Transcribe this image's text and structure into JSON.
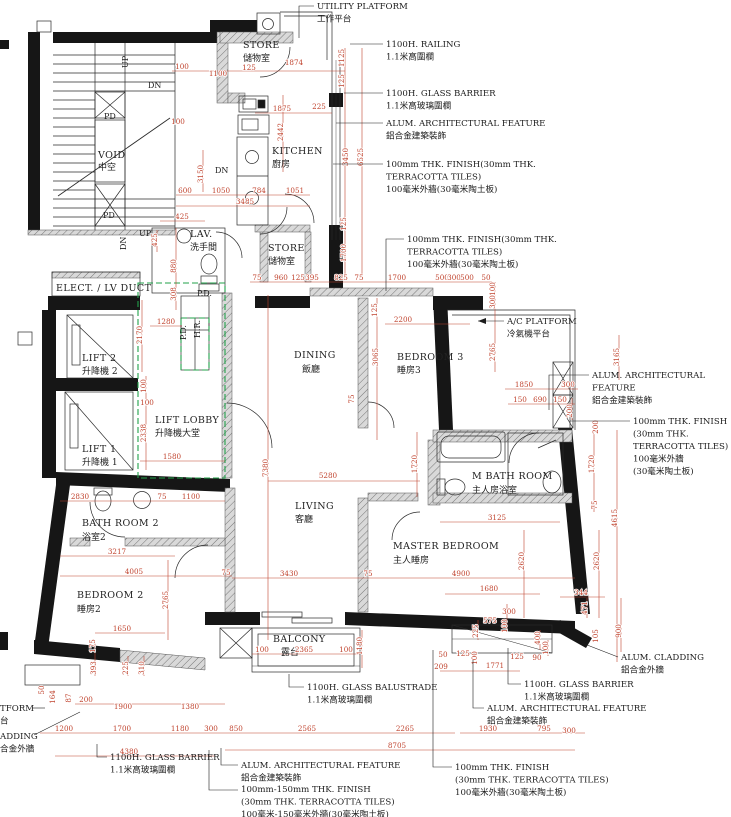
{
  "colors": {
    "dimension_red": "#c0432e",
    "wall_black": "#161616",
    "lobby_green": "#21a14a",
    "hatch_gray": "#8a8a8a"
  },
  "rooms": [
    {
      "en": "STORE",
      "zh": "儲物室",
      "x": 243,
      "y": 48,
      "zy": 61
    },
    {
      "en": "KITCHEN",
      "zh": "廚房",
      "x": 272,
      "y": 154,
      "zy": 167
    },
    {
      "en": "STORE",
      "zh": "儲物室",
      "x": 268,
      "y": 251,
      "zy": 264
    },
    {
      "en": "DINING",
      "zh": "飯廳",
      "x": 294,
      "y": 358,
      "zx": 302,
      "zy": 372
    },
    {
      "en": "BEDROOM 3",
      "zh": "睡房3",
      "x": 397,
      "y": 360,
      "zy": 373
    },
    {
      "en": "LIFT LOBBY",
      "zh": "升降機大堂",
      "x": 155,
      "y": 423,
      "zy": 436
    },
    {
      "en": "LIFT 2",
      "zh": "升降機 2",
      "x": 82,
      "y": 361,
      "zy": 374
    },
    {
      "en": "LIFT 1",
      "zh": "升降機 1",
      "x": 82,
      "y": 452,
      "zy": 465
    },
    {
      "en": "ELECT. / LV DUCT",
      "zh": "",
      "x": 56,
      "y": 291,
      "zy": 301
    },
    {
      "en": "LAV.",
      "zh": "洗手間",
      "x": 190,
      "y": 237,
      "zy": 250
    },
    {
      "en": "BATH ROOM 2",
      "zh": "浴室2",
      "x": 82,
      "y": 526,
      "zy": 540
    },
    {
      "en": "LIVING",
      "zh": "客廳",
      "x": 295,
      "y": 509,
      "zy": 522
    },
    {
      "en": "MASTER BEDROOM",
      "zh": "主人睡房",
      "x": 393,
      "y": 549,
      "zy": 563
    },
    {
      "en": "M BATH ROOM",
      "zh": "主人房浴室",
      "x": 472,
      "y": 479,
      "zy": 493
    },
    {
      "en": "BEDROOM 2",
      "zh": "睡房2",
      "x": 77,
      "y": 598,
      "zy": 612
    },
    {
      "en": "BALCONY",
      "zh": "露台",
      "x": 273,
      "y": 642,
      "zx": 281,
      "zy": 655
    },
    {
      "en": "VOID",
      "zh": "中空",
      "x": 98,
      "y": 158,
      "zy": 170
    }
  ],
  "small_labels": [
    {
      "t": "UP",
      "x": 128,
      "y": 68,
      "r": -90
    },
    {
      "t": "DN",
      "x": 148,
      "y": 88
    },
    {
      "t": "PD",
      "x": 104,
      "y": 119
    },
    {
      "t": "PD",
      "x": 103,
      "y": 218
    },
    {
      "t": "UP",
      "x": 139,
      "y": 236
    },
    {
      "t": "DN",
      "x": 126,
      "y": 250,
      "r": -90
    },
    {
      "t": "DN",
      "x": 215,
      "y": 173
    },
    {
      "t": "P.D.",
      "x": 197,
      "y": 296
    },
    {
      "t": "P.D.",
      "x": 186,
      "y": 340,
      "r": -90
    },
    {
      "t": "H.R.",
      "x": 200,
      "y": 338,
      "r": -90
    }
  ],
  "dims": [
    {
      "t": "100",
      "x": 182,
      "y": 69
    },
    {
      "t": "1100",
      "x": 218,
      "y": 76
    },
    {
      "t": "125",
      "x": 249,
      "y": 70
    },
    {
      "t": "1874",
      "x": 294,
      "y": 65
    },
    {
      "t": "1125",
      "x": 344,
      "y": 58,
      "r": 1
    },
    {
      "t": "125",
      "x": 344,
      "y": 81,
      "r": 1
    },
    {
      "t": "1875",
      "x": 282,
      "y": 111
    },
    {
      "t": "225",
      "x": 319,
      "y": 109
    },
    {
      "t": "100",
      "x": 178,
      "y": 124
    },
    {
      "t": "2442",
      "x": 283,
      "y": 132,
      "r": 1
    },
    {
      "t": "3450",
      "x": 348,
      "y": 157,
      "r": 1
    },
    {
      "t": "6525",
      "x": 363,
      "y": 157,
      "r": 1
    },
    {
      "t": "3150",
      "x": 203,
      "y": 174,
      "r": 1
    },
    {
      "t": "600",
      "x": 185,
      "y": 193
    },
    {
      "t": "1050",
      "x": 221,
      "y": 193
    },
    {
      "t": "784",
      "x": 259,
      "y": 193
    },
    {
      "t": "1051",
      "x": 295,
      "y": 193
    },
    {
      "t": "3485",
      "x": 245,
      "y": 204
    },
    {
      "t": "425",
      "x": 182,
      "y": 219
    },
    {
      "t": "425",
      "x": 157,
      "y": 240,
      "r": 1
    },
    {
      "t": "125",
      "x": 346,
      "y": 224,
      "r": 1
    },
    {
      "t": "1700",
      "x": 346,
      "y": 253,
      "r": 1
    },
    {
      "t": "880",
      "x": 176,
      "y": 266,
      "r": 1
    },
    {
      "t": "308",
      "x": 176,
      "y": 294,
      "r": 1
    },
    {
      "t": "75",
      "x": 257,
      "y": 280
    },
    {
      "t": "960",
      "x": 281,
      "y": 280
    },
    {
      "t": "125",
      "x": 298,
      "y": 280
    },
    {
      "t": "395",
      "x": 312,
      "y": 280
    },
    {
      "t": "825",
      "x": 341,
      "y": 280
    },
    {
      "t": "75",
      "x": 359,
      "y": 280
    },
    {
      "t": "1700",
      "x": 397,
      "y": 280
    },
    {
      "t": "500",
      "x": 442,
      "y": 280
    },
    {
      "t": "300",
      "x": 454,
      "y": 280
    },
    {
      "t": "500",
      "x": 467,
      "y": 280
    },
    {
      "t": "50",
      "x": 486,
      "y": 280
    },
    {
      "t": "100",
      "x": 495,
      "y": 289,
      "r": 1
    },
    {
      "t": "300",
      "x": 495,
      "y": 302,
      "r": 1
    },
    {
      "t": "125",
      "x": 377,
      "y": 310,
      "r": 1
    },
    {
      "t": "2200",
      "x": 403,
      "y": 322
    },
    {
      "t": "1280",
      "x": 166,
      "y": 324
    },
    {
      "t": "2170",
      "x": 142,
      "y": 335,
      "r": 1
    },
    {
      "t": "3065",
      "x": 378,
      "y": 357,
      "r": 1
    },
    {
      "t": "2765",
      "x": 495,
      "y": 352,
      "r": 1
    },
    {
      "t": "3165",
      "x": 619,
      "y": 357,
      "r": 1
    },
    {
      "t": "1850",
      "x": 524,
      "y": 387
    },
    {
      "t": "300",
      "x": 568,
      "y": 387
    },
    {
      "t": "150",
      "x": 520,
      "y": 402
    },
    {
      "t": "690",
      "x": 540,
      "y": 402
    },
    {
      "t": "150",
      "x": 560,
      "y": 402
    },
    {
      "t": "200",
      "x": 572,
      "y": 411,
      "r": 1
    },
    {
      "t": "100",
      "x": 146,
      "y": 386,
      "r": 1
    },
    {
      "t": "100",
      "x": 147,
      "y": 405
    },
    {
      "t": "2338",
      "x": 146,
      "y": 433,
      "r": 1
    },
    {
      "t": "1580",
      "x": 172,
      "y": 459
    },
    {
      "t": "7380",
      "x": 268,
      "y": 468,
      "r": 1
    },
    {
      "t": "5280",
      "x": 328,
      "y": 478
    },
    {
      "t": "2830",
      "x": 80,
      "y": 499
    },
    {
      "t": "75",
      "x": 162,
      "y": 499
    },
    {
      "t": "1100",
      "x": 191,
      "y": 499
    },
    {
      "t": "1720",
      "x": 417,
      "y": 464,
      "r": 1
    },
    {
      "t": "1720",
      "x": 594,
      "y": 464,
      "r": 1
    },
    {
      "t": "200",
      "x": 598,
      "y": 427,
      "r": 1
    },
    {
      "t": "75",
      "x": 597,
      "y": 505,
      "r": 1
    },
    {
      "t": "4615",
      "x": 617,
      "y": 518,
      "r": 1
    },
    {
      "t": "3125",
      "x": 497,
      "y": 520
    },
    {
      "t": "75",
      "x": 354,
      "y": 399,
      "r": 1
    },
    {
      "t": "3430",
      "x": 289,
      "y": 576
    },
    {
      "t": "75",
      "x": 368,
      "y": 576
    },
    {
      "t": "4900",
      "x": 461,
      "y": 576
    },
    {
      "t": "2620",
      "x": 524,
      "y": 561,
      "r": 1
    },
    {
      "t": "2620",
      "x": 599,
      "y": 561,
      "r": 1
    },
    {
      "t": "3217",
      "x": 117,
      "y": 554
    },
    {
      "t": "4005",
      "x": 134,
      "y": 574
    },
    {
      "t": "75",
      "x": 226,
      "y": 575
    },
    {
      "t": "2765",
      "x": 168,
      "y": 600,
      "r": 1
    },
    {
      "t": "1680",
      "x": 489,
      "y": 591
    },
    {
      "t": "344",
      "x": 581,
      "y": 595
    },
    {
      "t": "1650",
      "x": 122,
      "y": 631
    },
    {
      "t": "175",
      "x": 95,
      "y": 646,
      "r": 1
    },
    {
      "t": "393",
      "x": 96,
      "y": 668,
      "r": 1
    },
    {
      "t": "225",
      "x": 128,
      "y": 668,
      "r": 1
    },
    {
      "t": "310",
      "x": 144,
      "y": 668,
      "r": 1
    },
    {
      "t": "100",
      "x": 262,
      "y": 652
    },
    {
      "t": "2365",
      "x": 304,
      "y": 652
    },
    {
      "t": "100",
      "x": 346,
      "y": 652
    },
    {
      "t": "1180",
      "x": 362,
      "y": 646,
      "r": 1
    },
    {
      "t": "300",
      "x": 509,
      "y": 614
    },
    {
      "t": "575",
      "x": 490,
      "y": 623
    },
    {
      "t": "225",
      "x": 478,
      "y": 631,
      "r": 1
    },
    {
      "t": "100",
      "x": 507,
      "y": 626,
      "r": 1
    },
    {
      "t": "400",
      "x": 540,
      "y": 638,
      "r": 1
    },
    {
      "t": "100",
      "x": 548,
      "y": 648,
      "r": 1
    },
    {
      "t": "471",
      "x": 587,
      "y": 608,
      "r": 1
    },
    {
      "t": "105",
      "x": 598,
      "y": 636,
      "r": 1
    },
    {
      "t": "900",
      "x": 621,
      "y": 631,
      "r": 1
    },
    {
      "t": "50",
      "x": 443,
      "y": 657
    },
    {
      "t": "125",
      "x": 463,
      "y": 656
    },
    {
      "t": "209",
      "x": 441,
      "y": 669
    },
    {
      "t": "100",
      "x": 477,
      "y": 658,
      "r": 1
    },
    {
      "t": "1771",
      "x": 495,
      "y": 668
    },
    {
      "t": "125",
      "x": 517,
      "y": 659
    },
    {
      "t": "90",
      "x": 537,
      "y": 660
    },
    {
      "t": "50",
      "x": 44,
      "y": 690,
      "r": 1
    },
    {
      "t": "164",
      "x": 55,
      "y": 697,
      "r": 1
    },
    {
      "t": "87",
      "x": 71,
      "y": 698,
      "r": 1
    },
    {
      "t": "200",
      "x": 86,
      "y": 702
    },
    {
      "t": "1900",
      "x": 123,
      "y": 709
    },
    {
      "t": "1380",
      "x": 190,
      "y": 709
    },
    {
      "t": "1200",
      "x": 64,
      "y": 731
    },
    {
      "t": "1700",
      "x": 122,
      "y": 731
    },
    {
      "t": "1180",
      "x": 180,
      "y": 731
    },
    {
      "t": "300",
      "x": 211,
      "y": 731
    },
    {
      "t": "850",
      "x": 236,
      "y": 731
    },
    {
      "t": "2565",
      "x": 307,
      "y": 731
    },
    {
      "t": "2265",
      "x": 405,
      "y": 731
    },
    {
      "t": "8705",
      "x": 397,
      "y": 748
    },
    {
      "t": "4380",
      "x": 129,
      "y": 754
    },
    {
      "t": "1930",
      "x": 488,
      "y": 731
    },
    {
      "t": "795",
      "x": 544,
      "y": 731
    },
    {
      "t": "300",
      "x": 569,
      "y": 733
    }
  ],
  "annotations": [
    {
      "lines": [
        "UTILITY  PLATFORM",
        "工作平台"
      ],
      "x": 317,
      "y": 9,
      "leader": [
        [
          314,
          6
        ],
        [
          299,
          6
        ],
        [
          299,
          38
        ]
      ]
    },
    {
      "lines": [
        "1100H. RAILING",
        "1.1米高圍欄"
      ],
      "x": 386,
      "y": 47,
      "leader": [
        [
          383,
          44
        ],
        [
          350,
          44
        ]
      ]
    },
    {
      "lines": [
        "1100H. GLASS BARRIER",
        "1.1米高玻璃圍欄"
      ],
      "x": 386,
      "y": 96,
      "leader": [
        [
          383,
          93
        ],
        [
          344,
          93
        ]
      ]
    },
    {
      "lines": [
        "ALUM. ARCHITECTURAL FEATURE",
        "鋁合金建築裝飾"
      ],
      "x": 386,
      "y": 126,
      "leader": [
        [
          383,
          123
        ],
        [
          336,
          123
        ]
      ]
    },
    {
      "lines": [
        "100mm THK. FINISH(30mm THK.",
        "TERRACOTTA TILES)",
        "100毫米外牆(30毫米陶土板)"
      ],
      "x": 386,
      "y": 167,
      "leader": [
        [
          383,
          164
        ],
        [
          333,
          164
        ]
      ]
    },
    {
      "lines": [
        "100mm THK. FINISH(30mm THK.",
        "TERRACOTTA TILES)",
        "100毫米外牆(30毫米陶土板)"
      ],
      "x": 407,
      "y": 242,
      "leader": [
        [
          404,
          239
        ],
        [
          386,
          239
        ],
        [
          386,
          291
        ]
      ]
    },
    {
      "lines": [
        "A/C PLATFORM",
        "冷氣機平台"
      ],
      "x": 507,
      "y": 324,
      "leader": [
        [
          504,
          321
        ],
        [
          478,
          321
        ]
      ],
      "arrow": true
    },
    {
      "lines": [
        "ALUM. ARCHITECTURAL",
        "FEATURE",
        "鋁合金建築裝飾"
      ],
      "x": 592,
      "y": 378,
      "leader": [
        [
          589,
          375
        ],
        [
          549,
          375
        ],
        [
          549,
          410
        ]
      ]
    },
    {
      "lines": [
        "100mm THK. FINISH",
        "(30mm THK.",
        "TERRACOTTA TILES)",
        "100毫米外牆",
        "(30毫米陶土板)"
      ],
      "x": 633,
      "y": 424,
      "leader": [
        [
          630,
          421
        ],
        [
          570,
          421
        ]
      ]
    },
    {
      "lines": [
        "ALUM. CLADDING",
        "鋁合金外牆"
      ],
      "x": 621,
      "y": 660,
      "leader": [
        [
          618,
          657
        ],
        [
          582,
          643
        ]
      ]
    },
    {
      "lines": [
        "1100H. GLASS BARRIER",
        "1.1米高玻璃圍欄"
      ],
      "x": 524,
      "y": 687,
      "leader": [
        [
          521,
          684
        ],
        [
          508,
          684
        ],
        [
          508,
          648
        ]
      ]
    },
    {
      "lines": [
        "ALUM. ARCHITECTURAL FEATURE",
        "鋁合金建築裝飾"
      ],
      "x": 487,
      "y": 711,
      "leader": [
        [
          484,
          708
        ],
        [
          473,
          708
        ],
        [
          473,
          660
        ]
      ]
    },
    {
      "lines": [
        "100mm THK. FINISH",
        "(30mm THK. TERRACOTTA TILES)",
        "100毫米外牆(30毫米陶土板)"
      ],
      "x": 455,
      "y": 770,
      "leader": [
        [
          452,
          767
        ],
        [
          433,
          767
        ],
        [
          433,
          650
        ]
      ]
    },
    {
      "lines": [
        "1100H. GLASS BALUSTRADE",
        "1.1米高玻璃圍欄"
      ],
      "x": 307,
      "y": 690,
      "leader": [
        [
          304,
          687
        ],
        [
          289,
          687
        ],
        [
          289,
          674
        ]
      ]
    },
    {
      "lines": [
        "ALUM. ARCHITECTURAL FEATURE",
        "鋁合金建築裝飾"
      ],
      "x": 241,
      "y": 768,
      "leader": [
        [
          238,
          765
        ],
        [
          221,
          765
        ],
        [
          221,
          748
        ]
      ]
    },
    {
      "lines": [
        "100mm-150mm THK. FINISH",
        "(30mm THK. TERRACOTTA TILES)",
        "100毫米-150毫米外牆(30毫米陶土板)"
      ],
      "x": 241,
      "y": 792,
      "leader": [
        [
          238,
          790
        ],
        [
          209,
          790
        ],
        [
          209,
          750
        ]
      ]
    },
    {
      "lines": [
        "1100H. GLASS BARRIER",
        "1.1米高玻璃圍欄"
      ],
      "x": 110,
      "y": 760,
      "leader": [
        [
          107,
          757
        ],
        [
          97,
          757
        ],
        [
          97,
          744
        ]
      ]
    },
    {
      "lines": [
        "TFORM",
        "台"
      ],
      "x": 0,
      "y": 711,
      "leader": [
        [
          32,
          708
        ],
        [
          45,
          708
        ]
      ]
    },
    {
      "lines": [
        "ADDING",
        "合金外牆"
      ],
      "x": 0,
      "y": 739,
      "leader": [
        [
          34,
          735
        ],
        [
          80,
          712
        ]
      ]
    }
  ]
}
